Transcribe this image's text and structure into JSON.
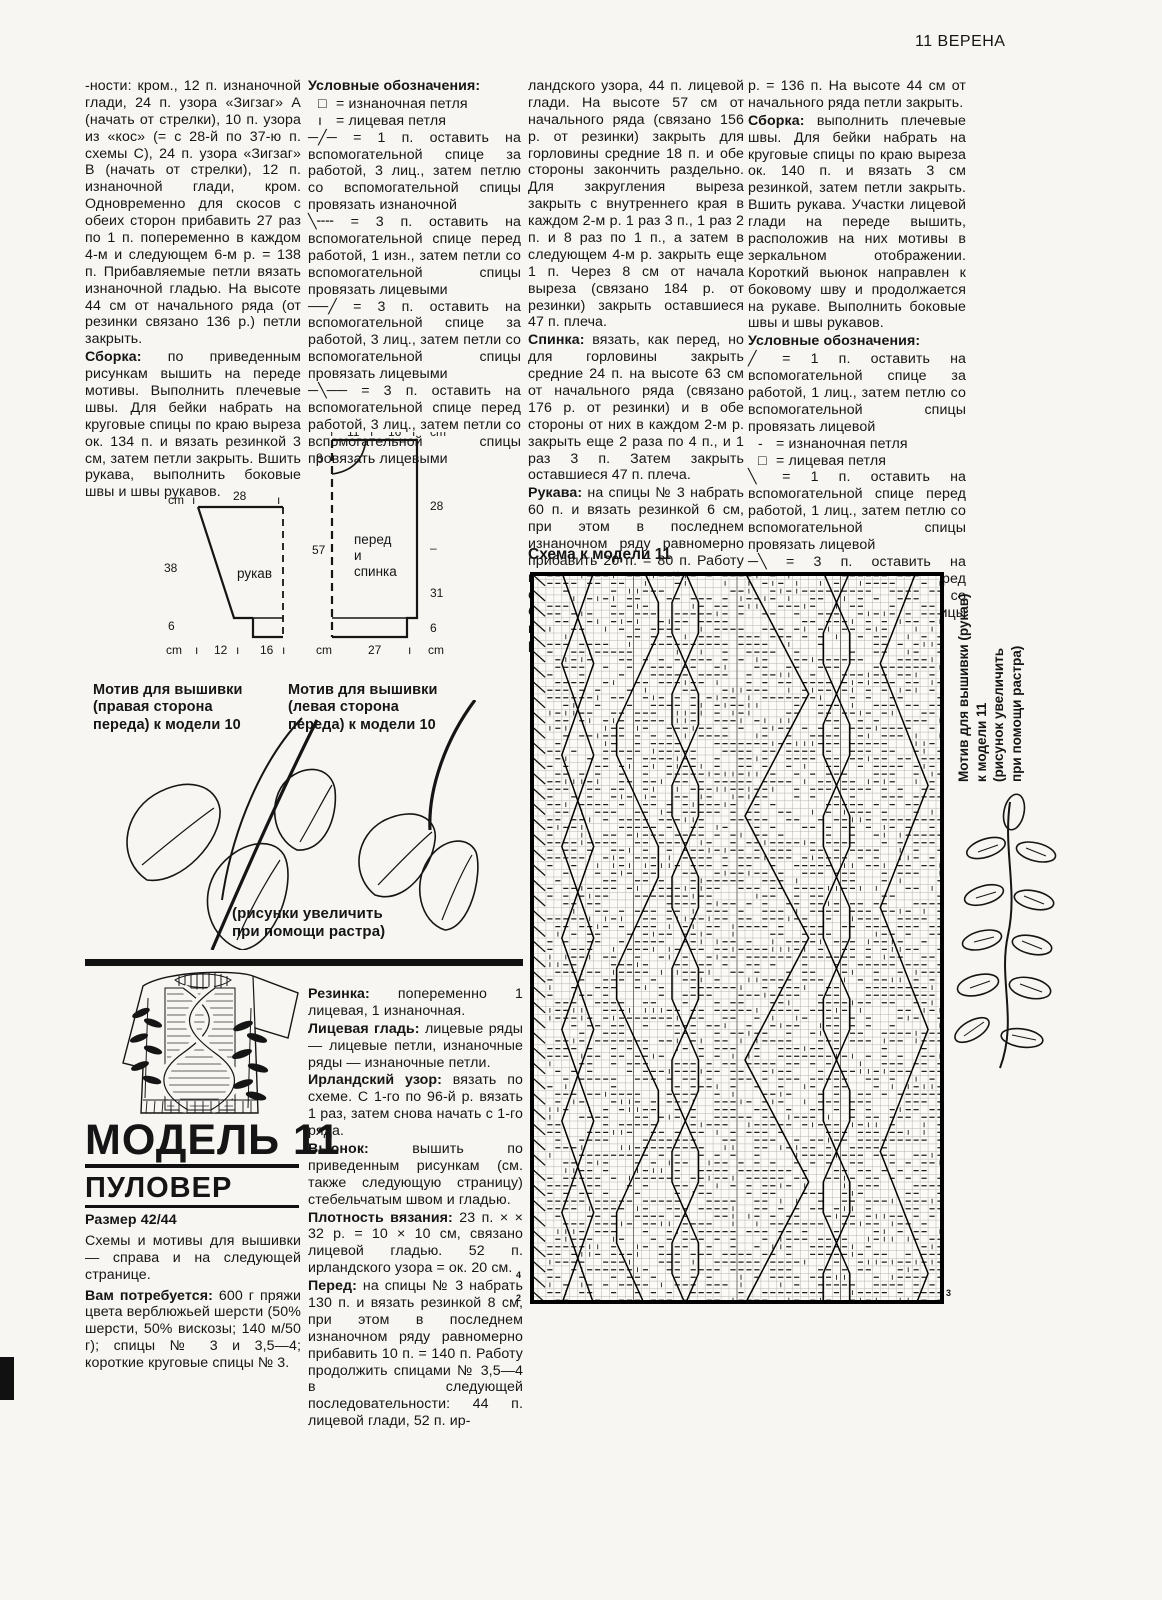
{
  "page_header": "11  ВЕРЕНА",
  "col1": {
    "p1_text": "-ности: кром., 12 п. изнаночной глади, 24 п. узора «Зигзаг» А (начать от стрелки), 10 п. узора из «кос» (= с 28-й по 37-ю п. схемы С), 24 п. узора «Зигзаг» В (начать от стрелки), 12 п. изнаночной глади, кром. Одновременно для скосов с обеих сторон прибавить 27 раз по 1 п. попеременно в каждом 4-м и следующем 6-м р. = 138 п. Прибавляемые петли вязать изнаночной гладью. На высоте 44 см от начального ряда (от резинки связано 136 р.) петли закрыть.",
    "p2_lead": "Сборка:",
    "p2_text": " по приведенным рисункам вышить на переде мотивы. Выполнить плечевые швы. Для бейки набрать на круговые спицы по краю выреза ок. 134 п. и вязать резинкой 3 см, затем петли закрыть. Вшить рукава, выполнить боковые швы и швы рукавов."
  },
  "legend1": {
    "heading": "Условные обозначения:",
    "items": [
      {
        "sym": "□",
        "text": "=  изнаночная петля"
      },
      {
        "sym": "ı",
        "text": "=  лицевая петля"
      },
      {
        "sym": "─╱─",
        "text": "=  1 п. оставить на вспомогательной спице за работой, 3 лиц., затем петлю со вспомогательной спицы провязать изнаночной"
      },
      {
        "sym": "╲╌╌",
        "text": "=  3 п. оставить на вспомогательной спице перед работой, 1 изн., затем петли со вспомогательной спицы провязать лицевыми"
      },
      {
        "sym": "──╱",
        "text": "=  3 п. оставить на вспомогательной спице за работой, 3 лиц., затем петли со вспомогательной спицы провязать лицевыми"
      },
      {
        "sym": "─╲──",
        "text": "=  3 п. оставить на вспомогательной спице перед работой, 3 лиц., затем петли со вспомогательной спицы провязать лицевыми"
      }
    ]
  },
  "col3": {
    "p1_text": "ландского узора, 44 п. лицевой глади. На высоте 57 см от начального ряда (связано 156 р. от резинки) закрыть для горловины средние 18 п. и обе стороны закончить раздельно. Для закругления выреза закрыть с внутреннего края в каждом 2-м р. 1 раз 3 п., 1 раз 2 п. и 8 раз по 1 п., а затем в следующем 4-м р. закрыть еще 1 п. Через 8 см от начала выреза (связано 184 р. от резинки) закрыть оставшиеся 47 п. плеча.",
    "p2_lead": "Спинка:",
    "p2_text": " вязать, как перед, но для горловины закрыть средние 24 п. на высоте 63 см от начального ряда (связано 176 р. от резинки) и в обе стороны от них в каждом 2-м р. закрыть еще 2 раза по 4 п., и 1 раз 3 п. Затем закрыть оставшиеся 47 п. плеча.",
    "p3_lead": "Рукава:",
    "p3_text": " на спицы № 3 набрать 60 п. и вязать резинкой 6 см, при этом в последнем изнаночном ряду равномерно прибавить 20 п. = 80 п. Работу продолжить лицевой гладью спицами № 3,5—4. Одновременно для скосов прибавить с обеих сторон 28 раз по 1 п. в каждом 4-м"
  },
  "col4": {
    "p1_text": "р. = 136 п. На высоте 44 см от начального ряда петли закрыть.",
    "p2_lead": "Сборка:",
    "p2_text": " выполнить плечевые швы. Для бейки набрать на круговые спицы по краю выреза ок. 140 п. и вязать 3 см резинкой, затем петли закрыть. Вшить рукава. Участки лицевой глади на переде вышить, расположив на них мотивы в зеркальном отображении. Короткий вьюнок направлен к боковому шву и продолжается на рукаве. Выполнить боковые швы и швы рукавов."
  },
  "legend2": {
    "heading": "Условные обозначения:",
    "items": [
      {
        "sym": "╱",
        "text": "=  1 п. оставить на вспомогательной спице за работой, 1 лиц., затем петлю со вспомогательной спицы провязать лицевой"
      },
      {
        "sym": "-",
        "text": "=  изнаночная петля"
      },
      {
        "sym": "□",
        "text": "=  лицевая петля"
      },
      {
        "sym": "╲",
        "text": "=  1 п. оставить на вспомогательной спице перед работой, 1 лиц., затем петлю со вспомогательной спицы провязать лицевой"
      },
      {
        "sym": "─╲",
        "text": "=  3 п. оставить на вспомогательной спице перед работой, 1 изн., затем петли со вспомогательной спицы провязать лицевыми"
      }
    ]
  },
  "schematic": {
    "sleeve": {
      "label": "рукав",
      "cm_top": "cm",
      "top_width": "28",
      "left_height": "38",
      "cuff_height": "6",
      "cm_bottom": "cm",
      "bottom_w1": "12",
      "bottom_w2": "16"
    },
    "body": {
      "label_1": "перед",
      "label_2": "и",
      "label_3": "спинка",
      "top_w1": "11",
      "top_w2": "16",
      "cm_top": "cm",
      "neck_depth": "8",
      "left_height": "57",
      "right_h1": "28",
      "right_h2": "31",
      "right_h3": "6",
      "cm_bottom_left": "cm",
      "bottom_width": "27",
      "cm_bottom_right": "cm"
    }
  },
  "motifs": {
    "left_label": "Мотив для вышивки (правая сторона переда) к модели 10",
    "right_label": "Мотив для вышивки (левая сторона переда) к модели 10",
    "note_line1": "(рисунки увеличить",
    "note_line2": "при помощи растра)"
  },
  "model11": {
    "title": "МОДЕЛЬ 11",
    "subtitle": "ПУЛОВЕР",
    "size": "Размер 42/44",
    "p1": "Схемы и мотивы для вышивки — справа и на следующей странице.",
    "p2_lead": "Вам потребуется:",
    "p2_text": " 600 г пряжи цвета верблюжьей шерсти (50% шерсти, 50% вискозы; 140 м/50 г); спицы № 3 и 3,5—4; короткие круговые спицы № 3."
  },
  "col2_bottom": {
    "p1_lead": "Резинка:",
    "p1_text": " попеременно 1 лицевая, 1 изнаночная.",
    "p2_lead": "Лицевая гладь:",
    "p2_text": " лицевые ряды — лицевые петли, изнаночные ряды — изнаночные петли.",
    "p3_lead": "Ирландский узор:",
    "p3_text": " вязать по схеме. С 1-го по 96-й р. вязать 1 раз, затем снова начать с 1-го ряда.",
    "p4_lead": "Вьюнок:",
    "p4_text": " вышить по приведенным рисункам (см. также следующую страницу) стебельчатым швом и гладью.",
    "p5_lead": "Плотность вязания:",
    "p5_text": " 23 п. × × 32 р. = 10 × 10 см, связано лицевой гладью. 52 п. ирландского узора = ок. 20 см.",
    "p6_lead": "Перед:",
    "p6_text": " на спицы № 3 набрать 130 п. и вязать резинкой 8 см, при этом в последнем изнаночном ряду равномерно прибавить 10 п. = 140 п. Работу продолжить спицами № 3,5—4 в следующей последовательности: 44 п. лицевой глади, 52 п. ир-"
  },
  "chart": {
    "title": "Схема к модели 11",
    "stitches": 52,
    "rows": 96,
    "seed": 7,
    "left_row_numbers": [
      "4",
      "2"
    ],
    "right_row_numbers": [
      "3"
    ]
  },
  "sleeve_motif_caption": {
    "line1": "Мотив для вышивки (рукав)",
    "line2": "к модели 11",
    "line3": "(рисунок увеличить",
    "line4": "при помощи растра)"
  },
  "colors": {
    "ink": "#151515",
    "paper": "#f7f6f2"
  }
}
